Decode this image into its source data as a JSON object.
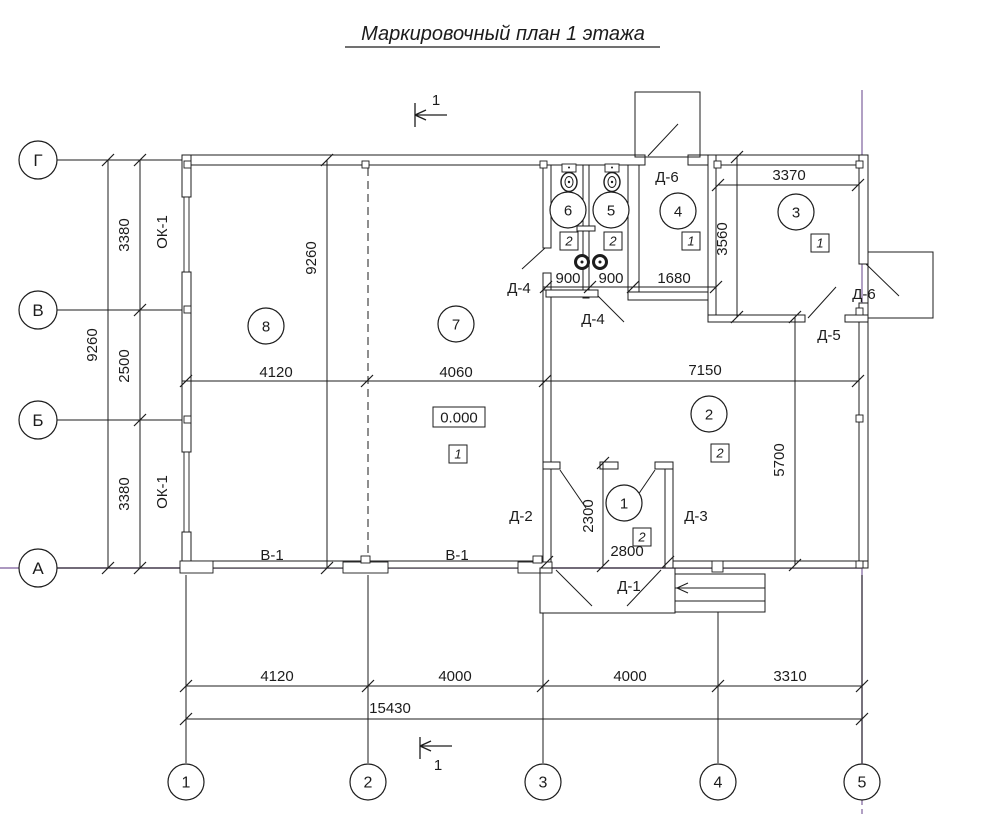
{
  "title": "Маркировочный план 1 этажа",
  "drawing": {
    "meta": {
      "width": 988,
      "height": 817,
      "ink": "#1c1c1c",
      "accent": "#9077ab",
      "background": "#ffffff"
    },
    "layers": [
      {
        "name": "axis-accent-line",
        "type": "line",
        "color": "#9077ab",
        "width": 1.4,
        "items": [
          [
            0,
            568,
            862,
            568
          ],
          [
            862,
            90,
            862,
            764
          ],
          [
            862,
            800,
            862,
            817,
            "5,4"
          ]
        ]
      },
      {
        "name": "axis-line",
        "type": "line",
        "items": [
          [
            57,
            160,
            182,
            160
          ],
          [
            57,
            310,
            182,
            310
          ],
          [
            57,
            420,
            182,
            420
          ],
          [
            57,
            568,
            182,
            568
          ],
          [
            186,
            575,
            186,
            763
          ],
          [
            368,
            575,
            368,
            763
          ],
          [
            543,
            613,
            543,
            763
          ],
          [
            718,
            612,
            718,
            763
          ],
          [
            862,
            575,
            862,
            763
          ]
        ]
      },
      {
        "name": "grid-dashed-line",
        "type": "line",
        "dash": "8,5",
        "items": [
          [
            368,
            168,
            368,
            558
          ]
        ]
      },
      {
        "name": "wall",
        "type": "wallrect",
        "items": [
          [
            182,
            155,
            463,
            10
          ],
          [
            688,
            155,
            180,
            10
          ],
          [
            182,
            155,
            9,
            42
          ],
          [
            182,
            272,
            9,
            180
          ],
          [
            182,
            532,
            9,
            36
          ],
          [
            859,
            155,
            9,
            109
          ],
          [
            859,
            303,
            9,
            265
          ],
          [
            182,
            561,
            369,
            7
          ],
          [
            665,
            561,
            203,
            7
          ],
          [
            543,
            290,
            8,
            278
          ],
          [
            543,
            165,
            8,
            83
          ],
          [
            543,
            273,
            8,
            17
          ],
          [
            583,
            165,
            6,
            133
          ],
          [
            577,
            226,
            18,
            5
          ],
          [
            628,
            165,
            11,
            127
          ],
          [
            546,
            290,
            52,
            7
          ],
          [
            628,
            292,
            88,
            8
          ],
          [
            708,
            155,
            8,
            167
          ],
          [
            708,
            315,
            97,
            7
          ],
          [
            845,
            315,
            23,
            7
          ],
          [
            665,
            462,
            8,
            106
          ],
          [
            543,
            462,
            17,
            7
          ],
          [
            600,
            462,
            18,
            7
          ],
          [
            655,
            462,
            18,
            7
          ]
        ]
      },
      {
        "name": "window-or-pier",
        "type": "wallrect",
        "sw": 0.9,
        "items": [
          [
            184,
            197,
            5,
            75
          ],
          [
            184,
            452,
            5,
            80
          ],
          [
            184,
            161,
            7,
            7
          ],
          [
            362,
            161,
            7,
            7
          ],
          [
            540,
            161,
            7,
            7
          ],
          [
            714,
            161,
            7,
            7
          ],
          [
            856,
            161,
            7,
            7
          ],
          [
            184,
            306,
            7,
            7
          ],
          [
            184,
            416,
            7,
            7
          ],
          [
            856,
            308,
            7,
            7
          ],
          [
            856,
            415,
            7,
            7
          ],
          [
            856,
            561,
            7,
            7
          ],
          [
            180,
            561,
            33,
            12
          ],
          [
            343,
            562,
            45,
            11
          ],
          [
            361,
            556,
            9,
            7
          ],
          [
            518,
            562,
            34,
            11
          ],
          [
            533,
            556,
            9,
            7
          ],
          [
            712,
            561,
            11,
            11
          ],
          [
            562,
            164,
            14,
            8
          ],
          [
            605,
            164,
            14,
            8
          ]
        ]
      },
      {
        "name": "structure-outline",
        "type": "outlinerect",
        "items": [
          [
            635,
            92,
            65,
            65
          ],
          [
            868,
            252,
            65,
            66
          ],
          [
            540,
            568,
            135,
            45
          ],
          [
            675,
            574,
            90,
            38
          ]
        ]
      },
      {
        "name": "step-line",
        "type": "line",
        "items": [
          [
            675,
            588,
            765,
            588
          ],
          [
            675,
            601,
            765,
            601
          ],
          [
            677,
            588,
            688,
            583
          ],
          [
            677,
            588,
            688,
            593
          ]
        ]
      },
      {
        "name": "dim-line",
        "type": "line",
        "items": [
          [
            108,
            160,
            108,
            568
          ],
          [
            140,
            160,
            140,
            568
          ],
          [
            327,
            160,
            327,
            568
          ],
          [
            182,
            381,
            858,
            381
          ],
          [
            718,
            185,
            858,
            185
          ],
          [
            737,
            157,
            737,
            317
          ],
          [
            543,
            287,
            716,
            287
          ],
          [
            603,
            463,
            603,
            566
          ],
          [
            795,
            317,
            795,
            565
          ],
          [
            186,
            686,
            862,
            686
          ],
          [
            186,
            719,
            862,
            719
          ]
        ]
      },
      {
        "name": "section-mark",
        "type": "line",
        "width": 1.3,
        "items": [
          [
            415,
            103,
            415,
            127
          ],
          [
            415,
            115,
            447,
            115
          ],
          [
            415,
            115,
            426,
            110
          ],
          [
            415,
            115,
            426,
            120
          ],
          [
            420,
            737,
            420,
            759
          ],
          [
            420,
            746,
            452,
            746
          ],
          [
            420,
            746,
            431,
            741
          ],
          [
            420,
            746,
            431,
            751
          ]
        ]
      },
      {
        "name": "door-leaf",
        "type": "line",
        "items": [
          [
            522,
            269,
            545,
            248
          ],
          [
            598,
            296,
            624,
            322
          ],
          [
            560,
            470,
            586,
            508
          ],
          [
            655,
            470,
            629,
            508
          ],
          [
            556,
            570,
            592,
            606
          ],
          [
            661,
            570,
            627,
            606
          ],
          [
            808,
            318,
            836,
            287
          ],
          [
            648,
            156,
            678,
            124
          ],
          [
            866,
            264,
            899,
            296
          ]
        ]
      },
      {
        "name": "title-underline",
        "type": "line",
        "width": 1.2,
        "items": [
          [
            345,
            47,
            660,
            47
          ]
        ]
      },
      {
        "name": "dim-tick",
        "type": "tick",
        "items": [
          [
            108,
            160
          ],
          [
            108,
            568
          ],
          [
            140,
            160
          ],
          [
            140,
            310
          ],
          [
            140,
            420
          ],
          [
            140,
            568
          ],
          [
            327,
            160
          ],
          [
            327,
            568
          ],
          [
            186,
            381
          ],
          [
            367,
            381
          ],
          [
            545,
            381
          ],
          [
            858,
            381
          ],
          [
            718,
            185
          ],
          [
            858,
            185
          ],
          [
            737,
            157
          ],
          [
            737,
            317
          ],
          [
            546,
            287
          ],
          [
            590,
            287
          ],
          [
            633,
            287
          ],
          [
            716,
            287
          ],
          [
            603,
            463
          ],
          [
            603,
            566
          ],
          [
            547,
            562
          ],
          [
            668,
            562
          ],
          [
            795,
            317
          ],
          [
            795,
            565
          ],
          [
            186,
            686
          ],
          [
            368,
            686
          ],
          [
            543,
            686
          ],
          [
            718,
            686
          ],
          [
            862,
            686
          ],
          [
            186,
            719
          ],
          [
            862,
            719
          ]
        ]
      },
      {
        "name": "toilet-bowl",
        "type": "ellipse",
        "items": [
          [
            569,
            182,
            8,
            9.5,
            1.4
          ],
          [
            569,
            182,
            4,
            5.5,
            1
          ],
          [
            612,
            182,
            8,
            9.5,
            1.4
          ],
          [
            612,
            182,
            4,
            5.5,
            1
          ]
        ]
      },
      {
        "name": "sink",
        "type": "ring",
        "items": [
          [
            582,
            262,
            6.5
          ],
          [
            600,
            262,
            6.5
          ]
        ]
      },
      {
        "name": "fixture-dot",
        "type": "dot",
        "items": [
          [
            569,
            182,
            1.2
          ],
          [
            612,
            182,
            1.2
          ],
          [
            569,
            167.5,
            1
          ],
          [
            612,
            167.5,
            1
          ],
          [
            582,
            262,
            1.5
          ],
          [
            600,
            262,
            1.5
          ]
        ]
      },
      {
        "name": "axis-bubble",
        "type": "bubble",
        "r": 19,
        "fs": 17,
        "items": [
          [
            "Г",
            38,
            160
          ],
          [
            "В",
            38,
            310
          ],
          [
            "Б",
            38,
            420
          ],
          [
            "А",
            38,
            568
          ]
        ]
      },
      {
        "name": "axis-bubble",
        "type": "bubble",
        "r": 18,
        "fs": 16,
        "items": [
          [
            "1",
            186,
            782
          ],
          [
            "2",
            368,
            782
          ],
          [
            "3",
            543,
            782
          ],
          [
            "4",
            718,
            782
          ],
          [
            "5",
            862,
            782
          ]
        ]
      },
      {
        "name": "room-bubble",
        "type": "bubble",
        "r": 18,
        "fs": 15,
        "items": [
          [
            "8",
            266,
            326
          ],
          [
            "7",
            456,
            324
          ],
          [
            "6",
            568,
            210
          ],
          [
            "5",
            611,
            210
          ],
          [
            "4",
            678,
            211
          ],
          [
            "3",
            796,
            212
          ],
          [
            "2",
            709,
            414
          ],
          [
            "1",
            624,
            503
          ]
        ]
      },
      {
        "name": "floor-type-marker",
        "type": "marker",
        "size": 18,
        "fs": 13,
        "items": [
          [
            "1",
            458,
            454
          ],
          [
            "2",
            569,
            241
          ],
          [
            "2",
            613,
            241
          ],
          [
            "1",
            691,
            241
          ],
          [
            "1",
            820,
            243
          ],
          [
            "2",
            720,
            453
          ],
          [
            "2",
            642,
            537
          ]
        ]
      },
      {
        "name": "level-mark",
        "type": "boxtext",
        "fs": 15,
        "items": [
          [
            "0.000",
            433,
            407,
            52,
            20
          ]
        ]
      },
      {
        "name": "dim-label",
        "type": "text",
        "fs": 15,
        "items": [
          [
            "9260",
            97,
            345,
            -90
          ],
          [
            "3380",
            129,
            235,
            -90
          ],
          [
            "2500",
            129,
            366,
            -90
          ],
          [
            "3380",
            129,
            494,
            -90
          ],
          [
            "9260",
            316,
            258,
            -90
          ],
          [
            "4120",
            276,
            377,
            0
          ],
          [
            "4060",
            456,
            377,
            0
          ],
          [
            "7150",
            705,
            375,
            0
          ],
          [
            "3370",
            789,
            180,
            0
          ],
          [
            "3560",
            727,
            239,
            -90
          ],
          [
            "900",
            568,
            283,
            0
          ],
          [
            "900",
            611,
            283,
            0
          ],
          [
            "1680",
            674,
            283,
            0
          ],
          [
            "2300",
            593,
            516,
            -90
          ],
          [
            "2800",
            627,
            556,
            0
          ],
          [
            "5700",
            784,
            460,
            -90
          ],
          [
            "4120",
            277,
            681,
            0
          ],
          [
            "4000",
            455,
            681,
            0
          ],
          [
            "4000",
            630,
            681,
            0
          ],
          [
            "3310",
            790,
            681,
            0
          ],
          [
            "15430",
            390,
            713,
            0
          ]
        ]
      },
      {
        "name": "tag-label",
        "type": "text",
        "fs": 15,
        "items": [
          [
            "Д-1",
            629,
            591,
            0
          ],
          [
            "Д-2",
            521,
            521,
            0
          ],
          [
            "Д-3",
            696,
            521,
            0
          ],
          [
            "Д-4",
            519,
            293,
            0
          ],
          [
            "Д-4",
            593,
            324,
            0
          ],
          [
            "Д-5",
            829,
            340,
            0
          ],
          [
            "Д-6",
            667,
            182,
            0
          ],
          [
            "Д-6",
            864,
            299,
            0
          ],
          [
            "В-1",
            272,
            560,
            0
          ],
          [
            "В-1",
            457,
            560,
            0
          ],
          [
            "ОК-1",
            167,
            232,
            -90
          ],
          [
            "ОК-1",
            167,
            492,
            -90
          ]
        ]
      },
      {
        "name": "section-label",
        "type": "text",
        "fs": 15,
        "items": [
          [
            "1",
            436,
            105,
            0
          ],
          [
            "1",
            438,
            770,
            0
          ]
        ]
      },
      {
        "name": "drawing-title",
        "type": "text",
        "fs": 20,
        "italic": true,
        "items": [
          [
            "Маркировочный план 1 этажа",
            503,
            40,
            0
          ]
        ]
      }
    ]
  }
}
